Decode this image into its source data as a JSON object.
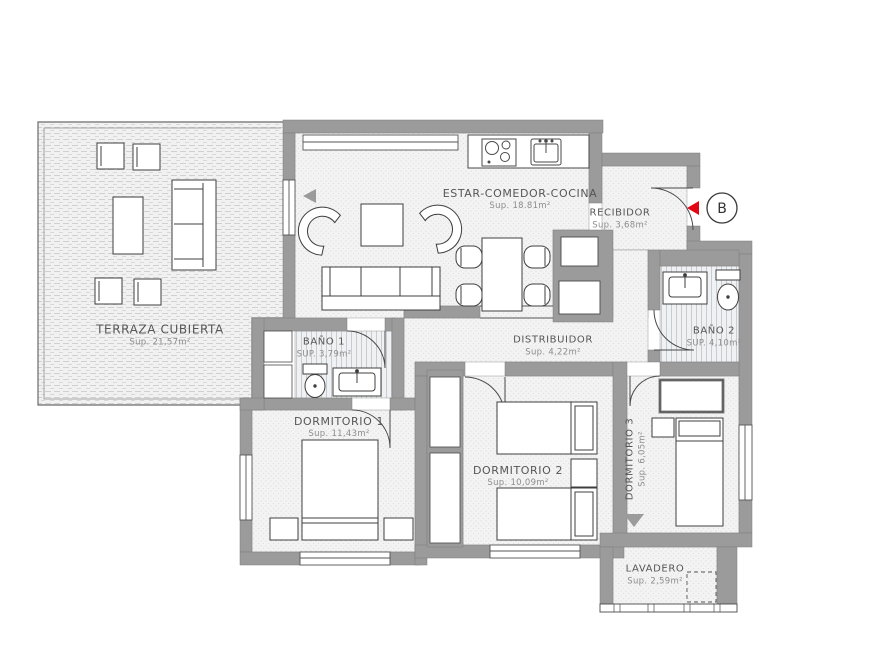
{
  "plan": {
    "rooms": [
      {
        "name": "TERRAZA CUBIERTA",
        "area": "Sup. 21,57m²"
      },
      {
        "name": "ESTAR-COMEDOR-COCINA",
        "area": "Sup. 18.81m²"
      },
      {
        "name": "RECIBIDOR",
        "area": "Sup. 3,68m²"
      },
      {
        "name": "BAÑO 1",
        "area": "SUP. 3,79m²"
      },
      {
        "name": "BAÑO 2",
        "area": "SUP. 4,10m²"
      },
      {
        "name": "DISTRIBUIDOR",
        "area": "Sup. 4,22m²"
      },
      {
        "name": "DORMITORIO 1",
        "area": "Sup. 11,43m²"
      },
      {
        "name": "DORMITORIO 2",
        "area": "Sup. 10,09m²"
      },
      {
        "name": "DORMITORIO 3",
        "area": "Sup. 6,05m²"
      },
      {
        "name": "LAVADERO",
        "area": "Sup. 2,59m²"
      }
    ],
    "entrance_marker": {
      "label": "B"
    },
    "colors": {
      "wall": "#9b9b9b",
      "accent_red": "#e30613",
      "line": "#4a4a4a",
      "floor": "#f3f3f3"
    }
  }
}
